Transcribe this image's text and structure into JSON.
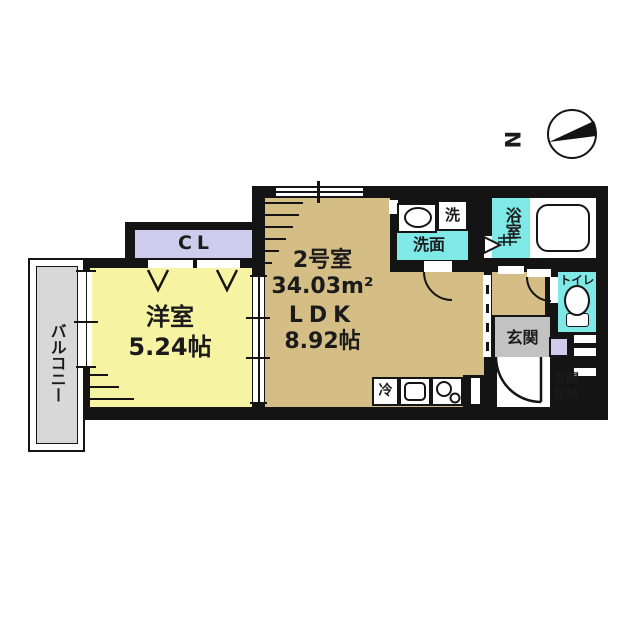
{
  "plan": {
    "unit": {
      "name": "2号室",
      "area": "34.03m²",
      "layout_type": "LDK",
      "layout_size": "8.92帖"
    },
    "rooms": {
      "western_room": {
        "name": "洋室",
        "size": "5.24帖"
      },
      "closet": {
        "label": "CL"
      },
      "balcony": {
        "name": "バルコニー"
      },
      "washroom": {
        "name": "洗面"
      },
      "washer_slot": {
        "label": "洗"
      },
      "bathroom": {
        "name": "浴室"
      },
      "toilet": {
        "name": "トイレ"
      },
      "entrance": {
        "name": "玄関"
      },
      "entrance_storage": {
        "name": "玄関収納"
      },
      "refrigerator": {
        "label": "冷"
      }
    },
    "compass": {
      "label": "N"
    },
    "colors": {
      "wall": "#141414",
      "ldk_floor": "#d5bd86",
      "western_room_floor": "#f6f3a3",
      "closet_fill": "#cfcbec",
      "wet_area_fill": "#7fe9e7",
      "entrance_fill": "#c2c2c2",
      "balcony_fill": "#d8d8d8"
    }
  }
}
